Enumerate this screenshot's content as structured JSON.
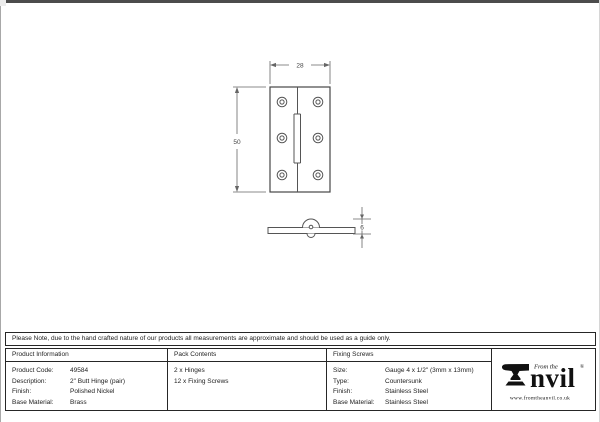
{
  "drawing": {
    "front_view": {
      "width_label": "28",
      "height_label": "50"
    },
    "side_view": {
      "thickness_label": "6"
    }
  },
  "note": {
    "text": "Please Note, due to the hand crafted nature of our products all measurements are approximate and should be used as a guide only."
  },
  "spec_table": {
    "product_information": {
      "header": "Product Information",
      "rows": [
        {
          "label": "Product Code:",
          "value": "49584"
        },
        {
          "label": "Description:",
          "value": "2\" Butt Hinge (pair)"
        },
        {
          "label": "Finish:",
          "value": "Polished Nickel"
        },
        {
          "label": "Base Material:",
          "value": "Brass"
        }
      ]
    },
    "pack_contents": {
      "header": "Pack Contents",
      "items": [
        "2 x Hinges",
        "12 x Fixing Screws"
      ]
    },
    "fixing_screws": {
      "header": "Fixing Screws",
      "rows": [
        {
          "label": "Size:",
          "value": "Gauge 4 x 1/2\" (3mm x 13mm)"
        },
        {
          "label": "Type:",
          "value": "Countersunk"
        },
        {
          "label": "Finish:",
          "value": "Stainless Steel"
        },
        {
          "label": "Base Material:",
          "value": "Stainless Steel"
        }
      ]
    }
  },
  "logo": {
    "tagline": "From the",
    "brand": "nvil",
    "registered_mark": "®",
    "website": "www.fromtheanvil.co.uk"
  },
  "colors": {
    "drawing_line": "#555555",
    "table_border": "#262626",
    "logo_ink": "#111111"
  }
}
